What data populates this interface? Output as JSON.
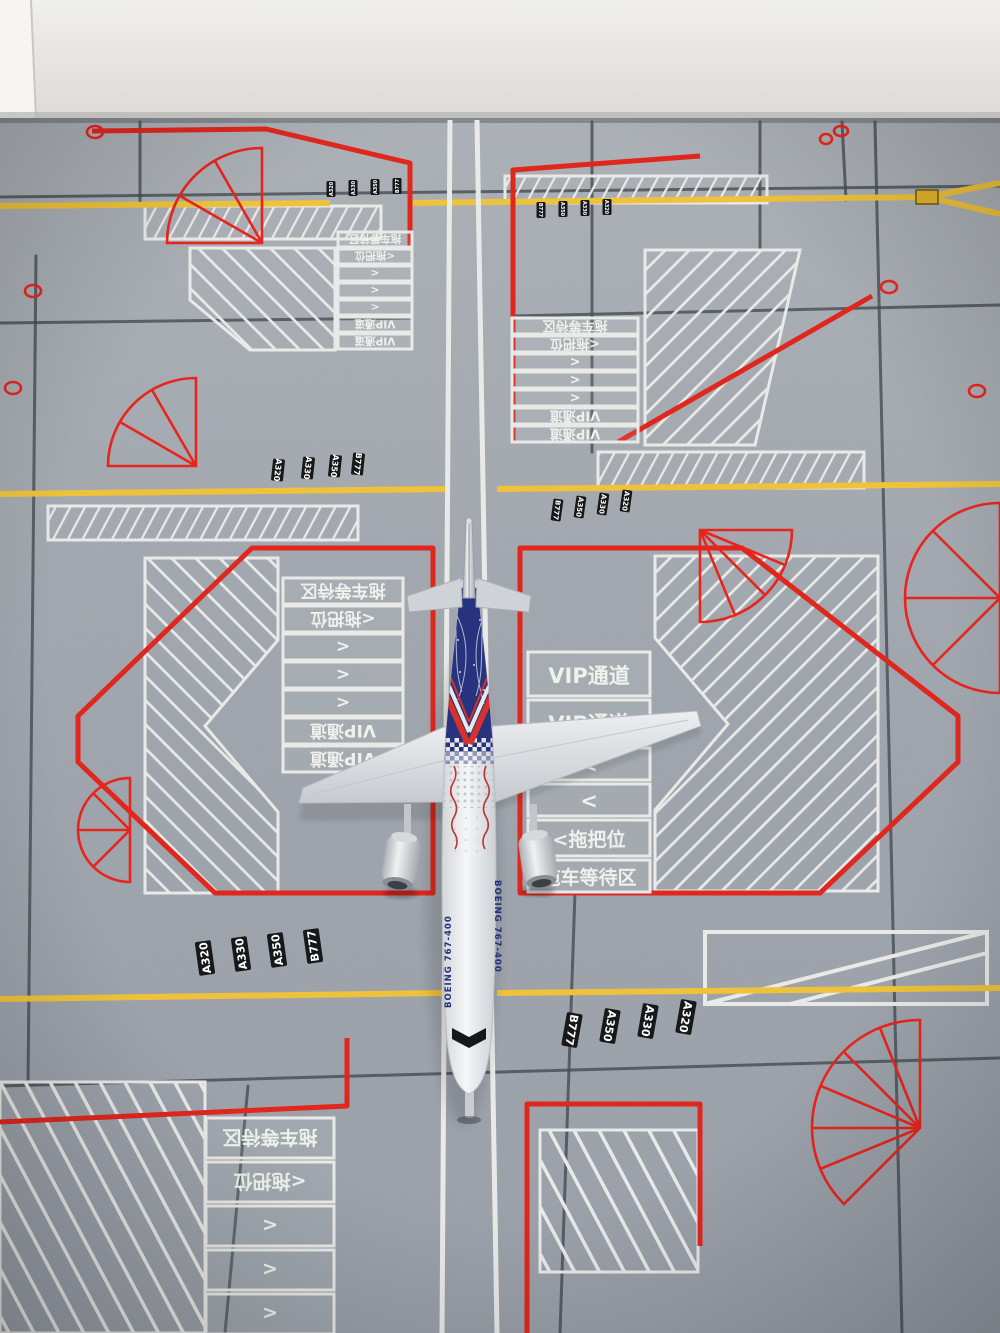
{
  "scene": {
    "type": "photograph",
    "subject": "diecast model airliner parked on a printed airport apron ground mat",
    "background": "white wall behind the mat"
  },
  "aircraft": {
    "fuselage_title": "BOEING 767-400",
    "colors": {
      "rear_fuselage_blue": "#27337f",
      "body_white": "#eff0f2",
      "script_red": "#c03233",
      "title_blue": "#24307e"
    }
  },
  "mat": {
    "ladder_rows_outbound": [
      "VIP通道",
      "VIP通道",
      "<",
      "<",
      "<拖把位",
      "拖车等待区"
    ],
    "ladder_rows_inbound": [
      "拖车等待区",
      "<拖把位",
      "<",
      "<",
      "<",
      "VIP通道",
      "VIP通道"
    ],
    "type_badges": [
      "A320",
      "A330",
      "A350",
      "B777"
    ],
    "type_badges_reversed": [
      "B777",
      "A350",
      "A330",
      "A320"
    ],
    "colors": {
      "surface_gray": "#9ba1a9",
      "stand_outline_red": "#e0271e",
      "taxi_line_white": "#e9eae7",
      "hold_line_yellow": "#eec23a",
      "grid_dark": "#454d53",
      "badge_black": "#17181a",
      "marking_text": "#eff1ec"
    }
  }
}
